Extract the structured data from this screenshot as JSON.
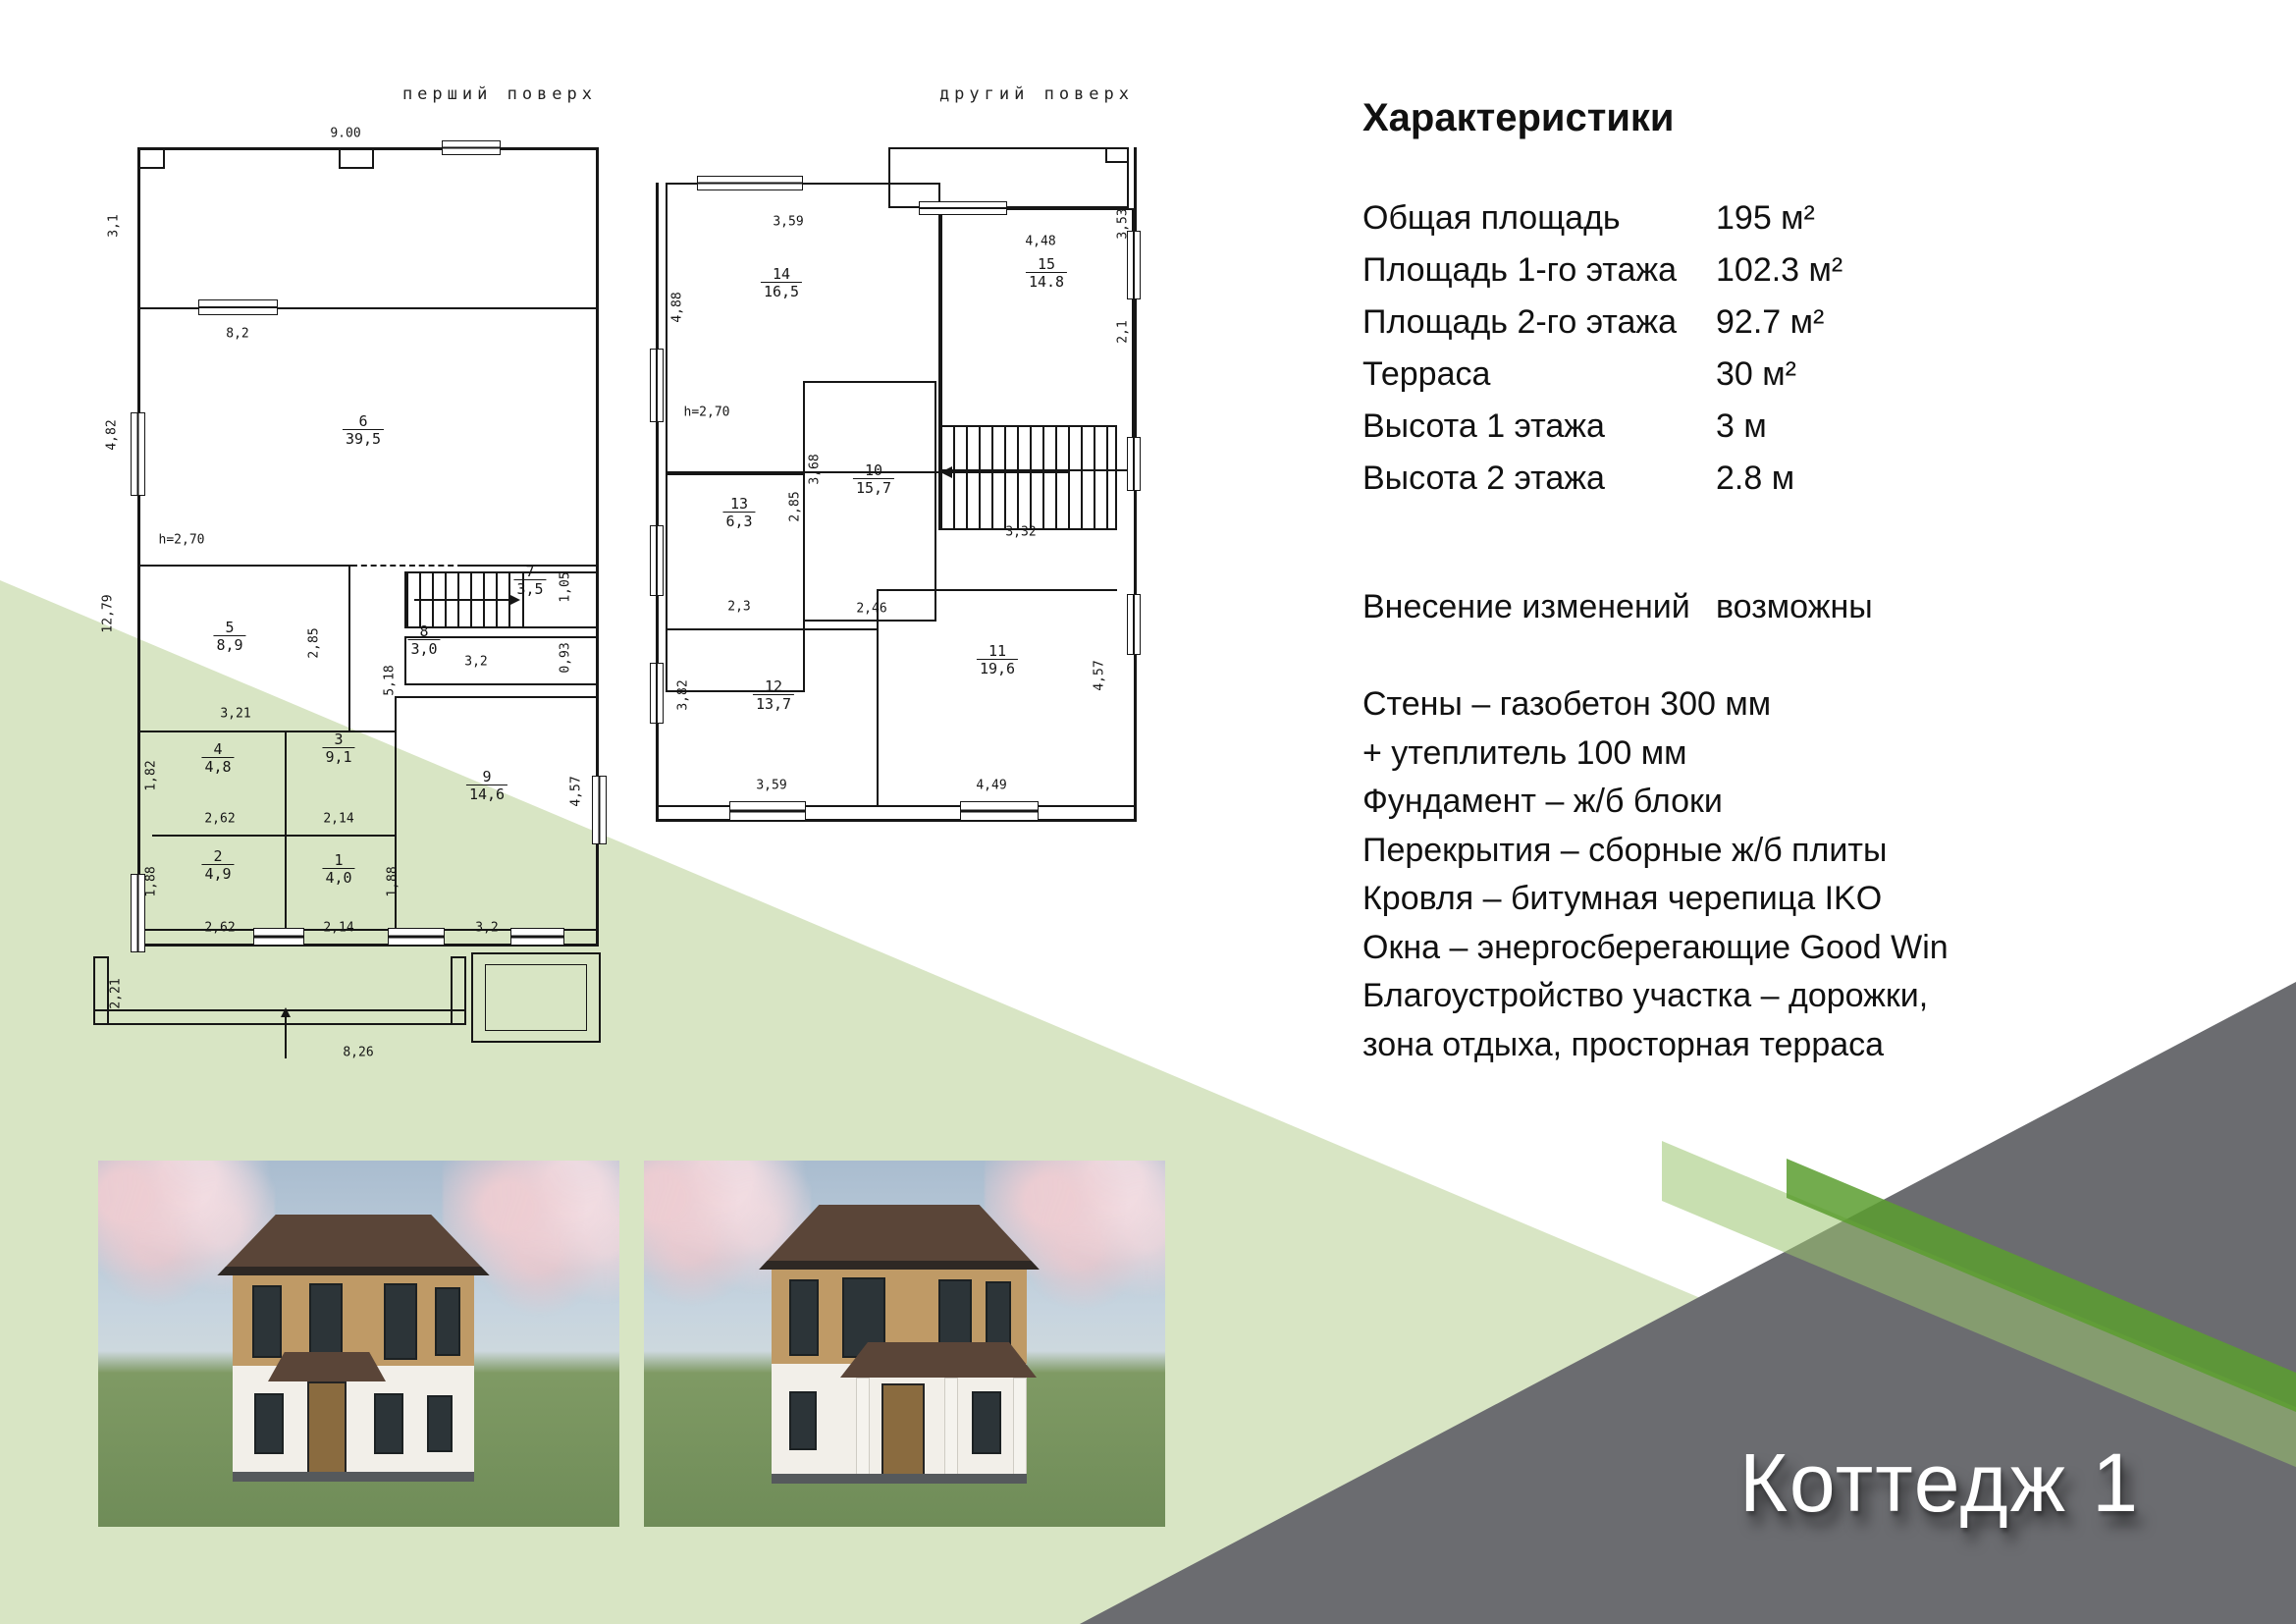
{
  "page": {
    "colors": {
      "pale_green": "#d8e5c4",
      "band_green": "#9bc470",
      "bright_green": "#5a9e2f",
      "slab_gray": "#6b6c70",
      "text": "#111111",
      "title_white": "#ffffff"
    }
  },
  "plans": {
    "first": {
      "title": "перший поверх",
      "rooms": [
        {
          "num": "1",
          "area": "4,0"
        },
        {
          "num": "2",
          "area": "4,9"
        },
        {
          "num": "3",
          "area": "9,1"
        },
        {
          "num": "4",
          "area": "4,8"
        },
        {
          "num": "5",
          "area": "8,9"
        },
        {
          "num": "6",
          "area": "39,5"
        },
        {
          "num": "7",
          "area": "3,5"
        },
        {
          "num": "8",
          "area": "3,0"
        },
        {
          "num": "9",
          "area": "14,6"
        }
      ],
      "dims": [
        {
          "text": "9.00"
        },
        {
          "text": "3,1"
        },
        {
          "text": "8,2"
        },
        {
          "text": "4,82"
        },
        {
          "text": "12,79"
        },
        {
          "text": "h=2,70"
        },
        {
          "text": "2,85"
        },
        {
          "text": "3,21"
        },
        {
          "text": "1,05"
        },
        {
          "text": "3,2"
        },
        {
          "text": "0,93"
        },
        {
          "text": "5,18"
        },
        {
          "text": "1,82"
        },
        {
          "text": "2,62"
        },
        {
          "text": "2,14"
        },
        {
          "text": "1,88"
        },
        {
          "text": "1,88"
        },
        {
          "text": "2,62"
        },
        {
          "text": "2,14"
        },
        {
          "text": "3,2"
        },
        {
          "text": "4,57"
        },
        {
          "text": "2,21"
        },
        {
          "text": "8,26"
        }
      ]
    },
    "second": {
      "title": "другий поверх",
      "rooms": [
        {
          "num": "10",
          "area": "15,7"
        },
        {
          "num": "11",
          "area": "19,6"
        },
        {
          "num": "12",
          "area": "13,7"
        },
        {
          "num": "13",
          "area": "6,3"
        },
        {
          "num": "14",
          "area": "16,5"
        },
        {
          "num": "15",
          "area": "14.8"
        }
      ],
      "dims": [
        {
          "text": "3,59"
        },
        {
          "text": "4,48"
        },
        {
          "text": "4,88"
        },
        {
          "text": "3,53"
        },
        {
          "text": "h=2,70"
        },
        {
          "text": "2,85"
        },
        {
          "text": "3,68"
        },
        {
          "text": "2,46"
        },
        {
          "text": "2,3"
        },
        {
          "text": "3,32"
        },
        {
          "text": "2,1"
        },
        {
          "text": "3,82"
        },
        {
          "text": "4,57"
        },
        {
          "text": "3,59"
        },
        {
          "text": "4,49"
        }
      ]
    }
  },
  "characteristics": {
    "title": "Характеристики",
    "specs": [
      {
        "label": "Общая площадь",
        "value": "195 м²"
      },
      {
        "label": "Площадь 1-го этажа",
        "value": "102.3 м²"
      },
      {
        "label": "Площадь 2-го этажа",
        "value": "92.7 м²"
      },
      {
        "label": "Терраса",
        "value": "30 м²"
      },
      {
        "label": "Высота 1 этажа",
        "value": "3 м"
      },
      {
        "label": "Высота 2 этажа",
        "value": "2.8 м"
      }
    ],
    "note": {
      "label": "Внесение изменений",
      "value": "возможны"
    },
    "details": [
      "Стены – газобетон 300 мм",
      "+ утеплитель 100 мм",
      "Фундамент – ж/б блоки",
      "Перекрытия – сборные ж/б плиты",
      "Кровля – битумная черепица IKO",
      "Окна – энергосберегающие  Good Win",
      "Благоустройство участка – дорожки,",
      "зона отдыха, просторная терраса"
    ]
  },
  "footer": {
    "title": "Коттедж 1"
  }
}
